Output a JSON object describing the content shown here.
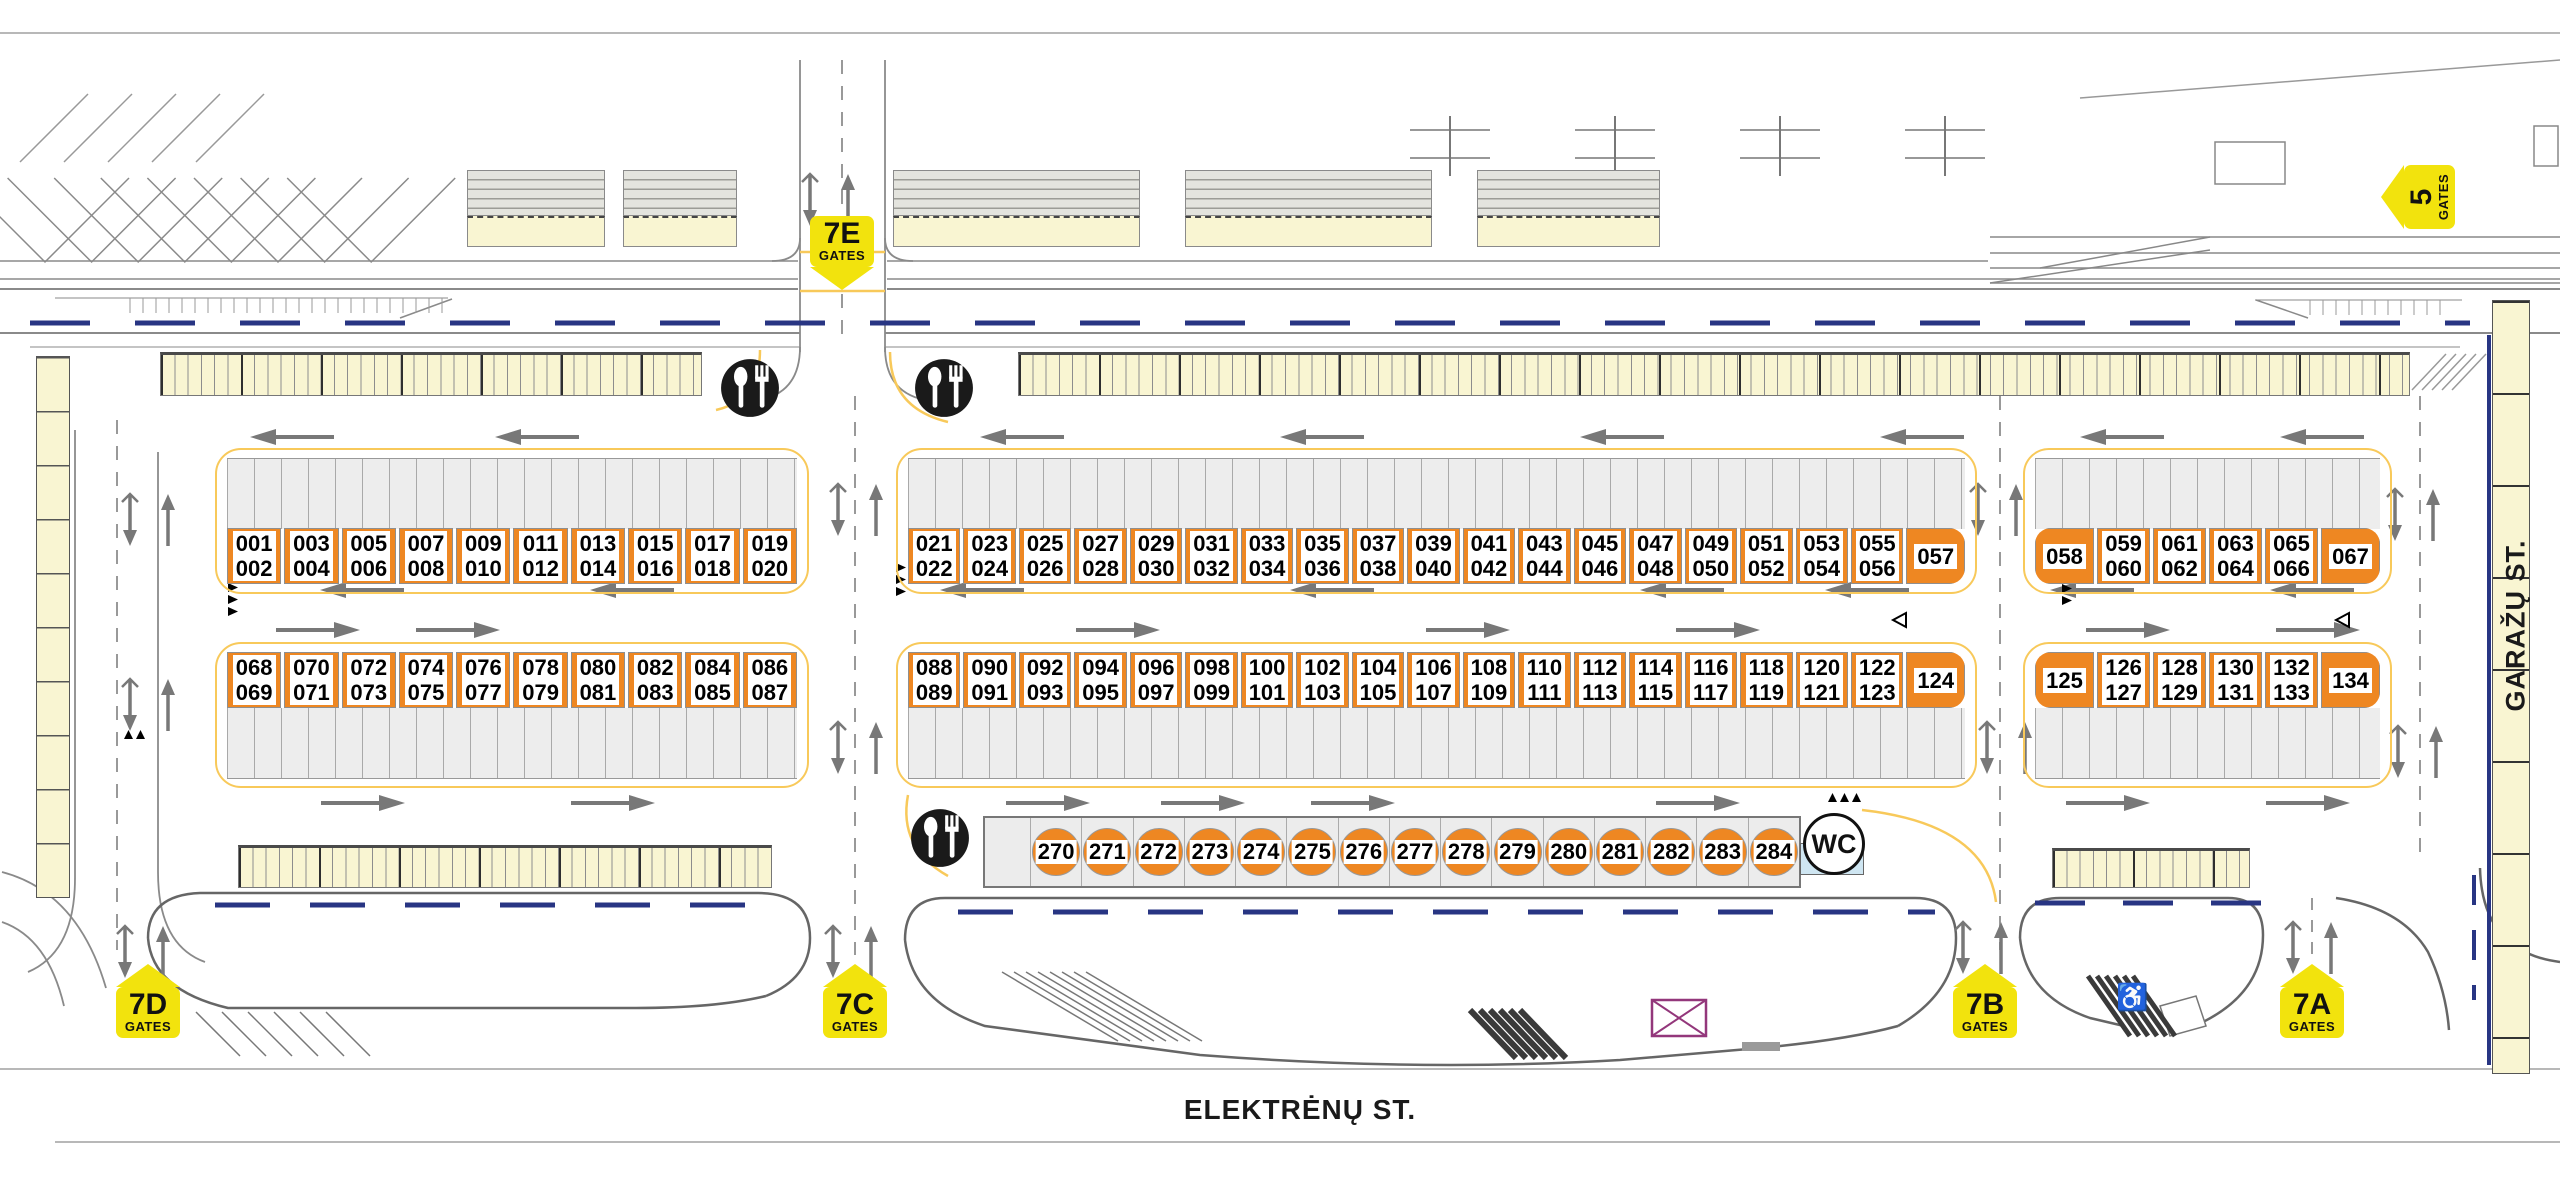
{
  "streets": {
    "bottom": "ELEKTRĖNŲ ST.",
    "right": "GARAŽŲ ST."
  },
  "gates": [
    {
      "id": "7E",
      "sub": "GATES"
    },
    {
      "id": "5",
      "sub": "GATES"
    },
    {
      "id": "7D",
      "sub": "GATES"
    },
    {
      "id": "7C",
      "sub": "GATES"
    },
    {
      "id": "7B",
      "sub": "GATES"
    },
    {
      "id": "7A",
      "sub": "GATES"
    }
  ],
  "blocks": {
    "row1_left": [
      [
        "001",
        "002"
      ],
      [
        "003",
        "004"
      ],
      [
        "005",
        "006"
      ],
      [
        "007",
        "008"
      ],
      [
        "009",
        "010"
      ],
      [
        "011",
        "012"
      ],
      [
        "013",
        "014"
      ],
      [
        "015",
        "016"
      ],
      [
        "017",
        "018"
      ],
      [
        "019",
        "020"
      ]
    ],
    "row1_mid": [
      [
        "021",
        "022"
      ],
      [
        "023",
        "024"
      ],
      [
        "025",
        "026"
      ],
      [
        "027",
        "028"
      ],
      [
        "029",
        "030"
      ],
      [
        "031",
        "032"
      ],
      [
        "033",
        "034"
      ],
      [
        "035",
        "036"
      ],
      [
        "037",
        "038"
      ],
      [
        "039",
        "040"
      ],
      [
        "041",
        "042"
      ],
      [
        "043",
        "044"
      ],
      [
        "045",
        "046"
      ],
      [
        "047",
        "048"
      ],
      [
        "049",
        "050"
      ],
      [
        "051",
        "052"
      ],
      [
        "053",
        "054"
      ],
      [
        "055",
        "056"
      ],
      [
        "057"
      ]
    ],
    "row1_right": [
      [
        "058"
      ],
      [
        "059",
        "060"
      ],
      [
        "061",
        "062"
      ],
      [
        "063",
        "064"
      ],
      [
        "065",
        "066"
      ],
      [
        "067"
      ]
    ],
    "row2_left": [
      [
        "068",
        "069"
      ],
      [
        "070",
        "071"
      ],
      [
        "072",
        "073"
      ],
      [
        "074",
        "075"
      ],
      [
        "076",
        "077"
      ],
      [
        "078",
        "079"
      ],
      [
        "080",
        "081"
      ],
      [
        "082",
        "083"
      ],
      [
        "084",
        "085"
      ],
      [
        "086",
        "087"
      ]
    ],
    "row2_mid": [
      [
        "088",
        "089"
      ],
      [
        "090",
        "091"
      ],
      [
        "092",
        "093"
      ],
      [
        "094",
        "095"
      ],
      [
        "096",
        "097"
      ],
      [
        "098",
        "099"
      ],
      [
        "100",
        "101"
      ],
      [
        "102",
        "103"
      ],
      [
        "104",
        "105"
      ],
      [
        "106",
        "107"
      ],
      [
        "108",
        "109"
      ],
      [
        "110",
        "111"
      ],
      [
        "112",
        "113"
      ],
      [
        "114",
        "115"
      ],
      [
        "116",
        "117"
      ],
      [
        "118",
        "119"
      ],
      [
        "120",
        "121"
      ],
      [
        "122",
        "123"
      ],
      [
        "124"
      ]
    ],
    "row2_right": [
      [
        "125"
      ],
      [
        "126",
        "127"
      ],
      [
        "128",
        "129"
      ],
      [
        "130",
        "131"
      ],
      [
        "132",
        "133"
      ],
      [
        "134"
      ]
    ]
  },
  "kiosks": {
    "numbers": [
      "270",
      "271",
      "272",
      "273",
      "274",
      "275",
      "276",
      "277",
      "278",
      "279",
      "280",
      "281",
      "282",
      "283",
      "284"
    ]
  },
  "wc_label": "WC",
  "icons": {
    "restaurant": "fork-and-spoon-icon",
    "wc": "wc-sign",
    "accessible": "wheelchair-icon"
  },
  "colors": {
    "stall_orange": "#EE8722",
    "gate_yellow": "#F2E30D",
    "building_cream": "#F9F5D2",
    "road_blue": "#283583",
    "parking_gray": "#EDEDED",
    "guide_yellow": "#F8C95A"
  }
}
